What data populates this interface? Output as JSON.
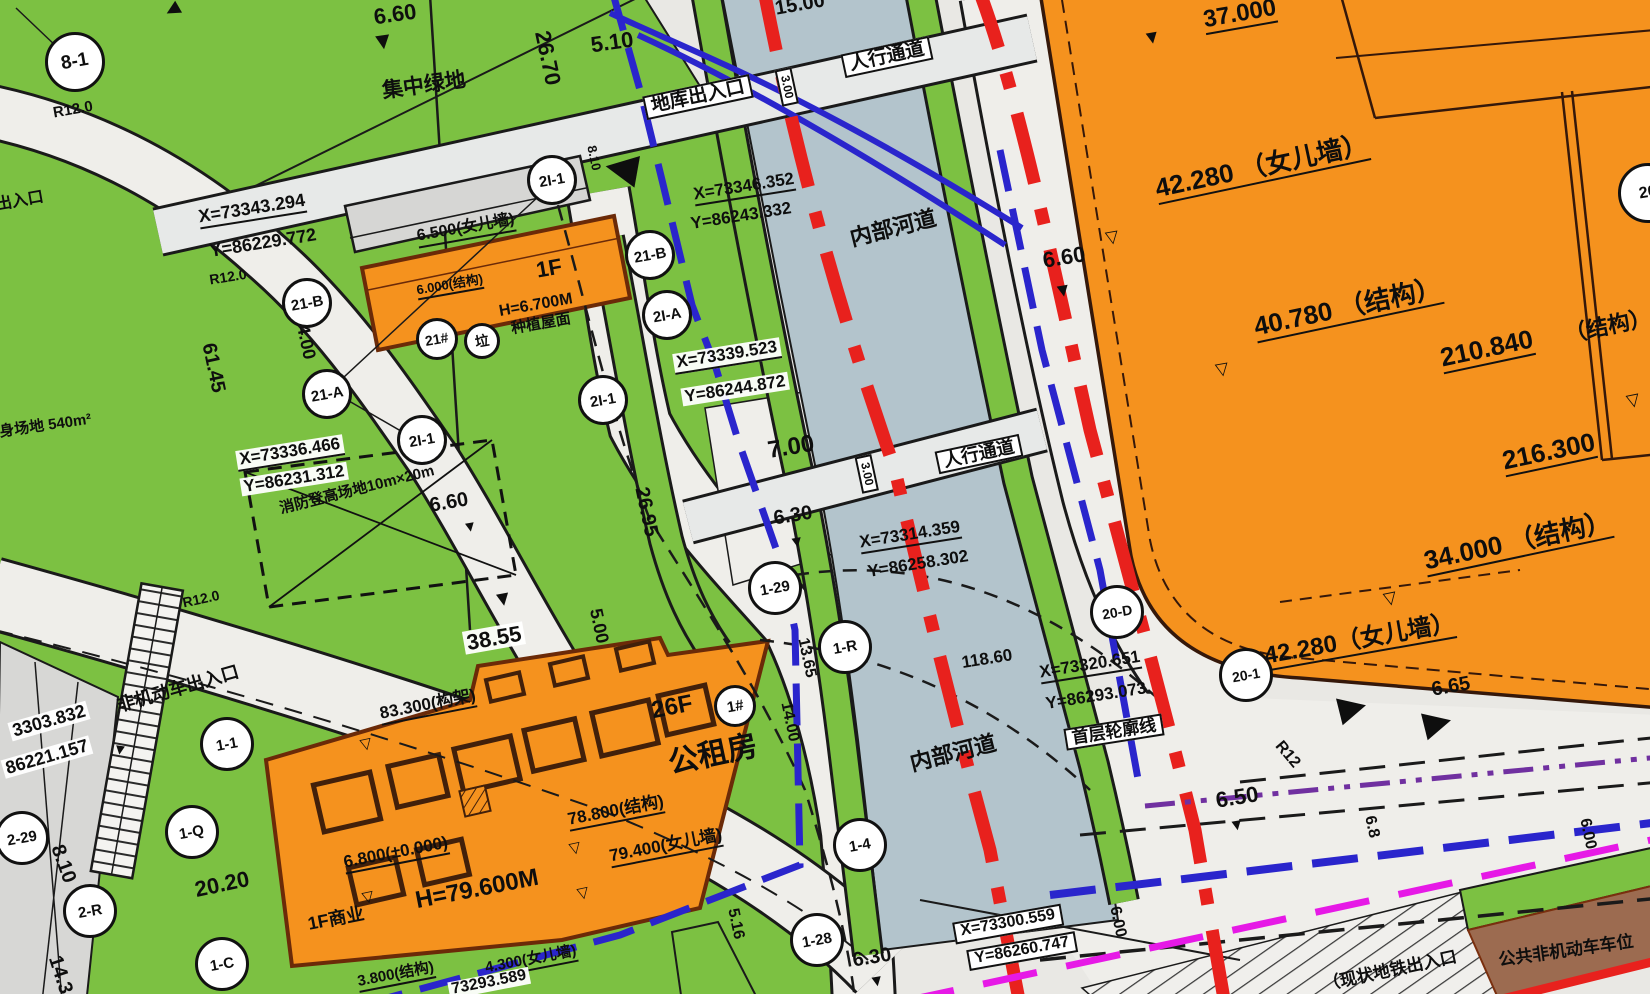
{
  "title": "site-plan-drawing",
  "colors": {
    "green_space": "#7cc142",
    "building_orange": "#f5921e",
    "building_edge": "#6b2a08",
    "river_blue_gray": "#b3c4cc",
    "road_gray": "#e9e8e4",
    "red_line": "#e8211d",
    "blue_line": "#2a25cc",
    "magenta_line": "#e619e6",
    "purple_line": "#7030a0",
    "brown_parking": "#9c6b50",
    "gray_building": "#d6d6d4"
  },
  "labels": [
    {
      "name": "radius-r12-topleft",
      "text": "R12.0",
      "x": 73,
      "y": 110,
      "rot": -10,
      "size": 15,
      "kind": ""
    },
    {
      "name": "exit-partial-left",
      "text": "出入口",
      "x": 20,
      "y": 202,
      "rot": -10,
      "size": 16,
      "kind": ""
    },
    {
      "name": "elev-6-60-top",
      "text": "6.60",
      "x": 395,
      "y": 14,
      "rot": -8,
      "size": 22,
      "kind": ""
    },
    {
      "name": "central-green-space",
      "text": "集中绿地",
      "x": 424,
      "y": 86,
      "rot": -8,
      "size": 21,
      "kind": ""
    },
    {
      "name": "dim-26-70",
      "text": "26.70",
      "x": 548,
      "y": 58,
      "rot": 78,
      "size": 22,
      "kind": ""
    },
    {
      "name": "dim-5-10",
      "text": "5.10",
      "x": 612,
      "y": 42,
      "rot": -8,
      "size": 22,
      "kind": ""
    },
    {
      "name": "garage-entrance",
      "text": "地库出入口",
      "x": 698,
      "y": 97,
      "rot": -12,
      "size": 19,
      "kind": "box"
    },
    {
      "name": "dim-3-00-top",
      "text": "3.00",
      "x": 787,
      "y": 87,
      "rot": 78,
      "size": 12,
      "kind": "box"
    },
    {
      "name": "pedestrian-passage-top",
      "text": "人行通道",
      "x": 887,
      "y": 57,
      "rot": -12,
      "size": 19,
      "kind": "box"
    },
    {
      "name": "dim-15-00",
      "text": "15.00",
      "x": 800,
      "y": 5,
      "rot": -10,
      "size": 20,
      "kind": ""
    },
    {
      "name": "dim-8-10-top",
      "text": "8.10",
      "x": 594,
      "y": 158,
      "rot": 78,
      "size": 13,
      "kind": ""
    },
    {
      "name": "coord-x-73343-294",
      "text": "X=73343.294",
      "x": 252,
      "y": 210,
      "rot": -9,
      "size": 18,
      "kind": "dim"
    },
    {
      "name": "coord-y-86229-772",
      "text": "Y=86229.772",
      "x": 263,
      "y": 243,
      "rot": -9,
      "size": 18,
      "kind": ""
    },
    {
      "name": "radius-r12-road",
      "text": "R12.0",
      "x": 228,
      "y": 277,
      "rot": -9,
      "size": 14,
      "kind": ""
    },
    {
      "name": "dim-4-00",
      "text": "4.00",
      "x": 306,
      "y": 342,
      "rot": 78,
      "size": 18,
      "kind": ""
    },
    {
      "name": "dim-61-45",
      "text": "61.45",
      "x": 213,
      "y": 368,
      "rot": 78,
      "size": 20,
      "kind": ""
    },
    {
      "name": "coord-x-73336-466",
      "text": "X=73336.466",
      "x": 290,
      "y": 453,
      "rot": -9,
      "size": 17,
      "kind": "wbg dim"
    },
    {
      "name": "coord-y-86231-312",
      "text": "Y=86231.312",
      "x": 294,
      "y": 479,
      "rot": -9,
      "size": 17,
      "kind": "wbg"
    },
    {
      "name": "fitness-area-540",
      "text": "健身场地 540m²",
      "x": 38,
      "y": 427,
      "rot": -8,
      "size": 15,
      "kind": ""
    },
    {
      "name": "roof-6-500-parapet",
      "text": "6.500(女儿墙)",
      "x": 466,
      "y": 230,
      "rot": -10,
      "size": 16,
      "kind": "dim"
    },
    {
      "name": "roof-6-000-structure",
      "text": "6.000(结构)",
      "x": 450,
      "y": 286,
      "rot": -10,
      "size": 13,
      "kind": "dim"
    },
    {
      "name": "floors-1f",
      "text": "1F",
      "x": 549,
      "y": 268,
      "rot": -10,
      "size": 22,
      "kind": ""
    },
    {
      "name": "height-6-700",
      "text": "H=6.700M",
      "x": 536,
      "y": 306,
      "rot": -10,
      "size": 16,
      "kind": ""
    },
    {
      "name": "planted-roof",
      "text": "种植屋面",
      "x": 541,
      "y": 324,
      "rot": -10,
      "size": 15,
      "kind": ""
    },
    {
      "name": "coord-x-73346-352",
      "text": "X=73346.352",
      "x": 744,
      "y": 188,
      "rot": -9,
      "size": 17,
      "kind": "dim"
    },
    {
      "name": "coord-y-86243-332",
      "text": "Y=86243.332",
      "x": 741,
      "y": 216,
      "rot": -9,
      "size": 17,
      "kind": ""
    },
    {
      "name": "coord-x-73339-523",
      "text": "X=73339.523",
      "x": 727,
      "y": 356,
      "rot": -9,
      "size": 17,
      "kind": "wbg dim"
    },
    {
      "name": "coord-y-86244-872",
      "text": "Y=86244.872",
      "x": 735,
      "y": 389,
      "rot": -9,
      "size": 17,
      "kind": "wbg"
    },
    {
      "name": "dim-26-95",
      "text": "26.95",
      "x": 646,
      "y": 512,
      "rot": 78,
      "size": 20,
      "kind": ""
    },
    {
      "name": "dim-7-00",
      "text": "7.00",
      "x": 791,
      "y": 447,
      "rot": -9,
      "size": 24,
      "kind": ""
    },
    {
      "name": "elev-6-30-mid",
      "text": "6.30",
      "x": 793,
      "y": 516,
      "rot": -9,
      "size": 20,
      "kind": ""
    },
    {
      "name": "dim-3-00-mid",
      "text": "3.00",
      "x": 867,
      "y": 474,
      "rot": 78,
      "size": 12,
      "kind": "box"
    },
    {
      "name": "pedestrian-passage-mid",
      "text": "人行通道",
      "x": 979,
      "y": 454,
      "rot": -12,
      "size": 18,
      "kind": "box"
    },
    {
      "name": "river-label-top",
      "text": "内部河道",
      "x": 893,
      "y": 228,
      "rot": -14,
      "size": 22,
      "kind": ""
    },
    {
      "name": "elev-6-60-right",
      "text": "6.60",
      "x": 1064,
      "y": 257,
      "rot": -9,
      "size": 22,
      "kind": ""
    },
    {
      "name": "river-label-bottom",
      "text": "内部河道",
      "x": 953,
      "y": 753,
      "rot": -14,
      "size": 22,
      "kind": ""
    },
    {
      "name": "coord-x-73314-359",
      "text": "X=73314.359",
      "x": 910,
      "y": 536,
      "rot": -9,
      "size": 17,
      "kind": "dim"
    },
    {
      "name": "coord-y-86258-302",
      "text": "Y=86258.302",
      "x": 918,
      "y": 564,
      "rot": -9,
      "size": 17,
      "kind": ""
    },
    {
      "name": "dim-118-60",
      "text": "118.60",
      "x": 987,
      "y": 659,
      "rot": -9,
      "size": 17,
      "kind": ""
    },
    {
      "name": "coord-x-73320-651",
      "text": "X=73320.651",
      "x": 1090,
      "y": 666,
      "rot": -9,
      "size": 17,
      "kind": "dim"
    },
    {
      "name": "coord-y-86293-073",
      "text": "Y=86293.073",
      "x": 1096,
      "y": 696,
      "rot": -9,
      "size": 17,
      "kind": ""
    },
    {
      "name": "first-floor-outline",
      "text": "首层轮廓线",
      "x": 1114,
      "y": 732,
      "rot": -9,
      "size": 17,
      "kind": "box"
    },
    {
      "name": "radius-r12-corner",
      "text": "R12",
      "x": 1287,
      "y": 755,
      "rot": 50,
      "size": 16,
      "kind": ""
    },
    {
      "name": "elev-6-50",
      "text": "6.50",
      "x": 1237,
      "y": 797,
      "rot": -9,
      "size": 22,
      "kind": ""
    },
    {
      "name": "dim-13-65",
      "text": "13.65",
      "x": 806,
      "y": 658,
      "rot": 78,
      "size": 16,
      "kind": ""
    },
    {
      "name": "dim-14-00",
      "text": "14.00",
      "x": 789,
      "y": 722,
      "rot": 78,
      "size": 16,
      "kind": ""
    },
    {
      "name": "dim-5-16",
      "text": "5.16",
      "x": 735,
      "y": 924,
      "rot": 78,
      "size": 16,
      "kind": ""
    },
    {
      "name": "elev-6-30-bottom",
      "text": "6.30",
      "x": 872,
      "y": 958,
      "rot": -9,
      "size": 20,
      "kind": ""
    },
    {
      "name": "coord-x-73300-559",
      "text": "X=73300.559",
      "x": 1008,
      "y": 924,
      "rot": -10,
      "size": 16,
      "kind": "box dim"
    },
    {
      "name": "coord-y-86260-747",
      "text": "Y=86260.747",
      "x": 1022,
      "y": 951,
      "rot": -10,
      "size": 16,
      "kind": "box"
    },
    {
      "name": "dim-6-00-left",
      "text": "6.00",
      "x": 1117,
      "y": 922,
      "rot": 78,
      "size": 16,
      "kind": ""
    },
    {
      "name": "dim-6-8",
      "text": "6.8",
      "x": 1371,
      "y": 827,
      "rot": 78,
      "size": 16,
      "kind": ""
    },
    {
      "name": "dim-6-00-right",
      "text": "6.00",
      "x": 1587,
      "y": 834,
      "rot": 78,
      "size": 16,
      "kind": ""
    },
    {
      "name": "existing-metro-exit",
      "text": "（现状地铁出入口",
      "x": 1390,
      "y": 971,
      "rot": -12,
      "size": 17,
      "kind": ""
    },
    {
      "name": "public-bicycle-parking",
      "text": "公共非机动车车位",
      "x": 1566,
      "y": 951,
      "rot": -8,
      "size": 17,
      "kind": ""
    },
    {
      "name": "roof-42-280-parapet-low",
      "text": "42.280（女儿墙）",
      "x": 1360,
      "y": 641,
      "rot": -10,
      "size": 24,
      "kind": "dim"
    },
    {
      "name": "elev-6-65",
      "text": "6.65",
      "x": 1451,
      "y": 687,
      "rot": -10,
      "size": 20,
      "kind": ""
    },
    {
      "name": "roof-37-000",
      "text": "37.000",
      "x": 1240,
      "y": 15,
      "rot": -10,
      "size": 24,
      "kind": "dim"
    },
    {
      "name": "roof-42-280-parapet",
      "text": "42.280 （女儿墙）",
      "x": 1262,
      "y": 168,
      "rot": -12,
      "size": 26,
      "kind": "dim"
    },
    {
      "name": "roof-40-780-structure",
      "text": "40.780 （结构）",
      "x": 1348,
      "y": 309,
      "rot": -12,
      "size": 26,
      "kind": "dim"
    },
    {
      "name": "roof-210-840",
      "text": "210.840",
      "x": 1487,
      "y": 350,
      "rot": -12,
      "size": 26,
      "kind": "dim"
    },
    {
      "name": "roof-210-840-structure",
      "text": "（结构）",
      "x": 1608,
      "y": 326,
      "rot": -12,
      "size": 22,
      "kind": ""
    },
    {
      "name": "roof-216-300",
      "text": "216.300",
      "x": 1549,
      "y": 453,
      "rot": -12,
      "size": 26,
      "kind": "dim"
    },
    {
      "name": "roof-34-000-structure",
      "text": "34.000 （结构）",
      "x": 1518,
      "y": 543,
      "rot": -12,
      "size": 26,
      "kind": "dim"
    },
    {
      "name": "fire-truck-area",
      "text": "消防登高场地10m×20m",
      "x": 357,
      "y": 490,
      "rot": -14,
      "size": 15,
      "kind": ""
    },
    {
      "name": "elev-6-60-fire",
      "text": "6.60",
      "x": 449,
      "y": 503,
      "rot": -10,
      "size": 20,
      "kind": ""
    },
    {
      "name": "dim-38-55",
      "text": "38.55",
      "x": 494,
      "y": 638,
      "rot": -10,
      "size": 22,
      "kind": "wbg"
    },
    {
      "name": "dim-5-00",
      "text": "5.00",
      "x": 599,
      "y": 626,
      "rot": 78,
      "size": 18,
      "kind": ""
    },
    {
      "name": "roof-83-300-frame",
      "text": "83.300(构架)",
      "x": 428,
      "y": 706,
      "rot": -11,
      "size": 17,
      "kind": "dim"
    },
    {
      "name": "floors-26f",
      "text": "26F",
      "x": 672,
      "y": 707,
      "rot": -11,
      "size": 24,
      "kind": ""
    },
    {
      "name": "public-rental-housing",
      "text": "公租房",
      "x": 713,
      "y": 755,
      "rot": -12,
      "size": 30,
      "kind": ""
    },
    {
      "name": "roof-78-800-structure",
      "text": "78.800(结构)",
      "x": 616,
      "y": 812,
      "rot": -11,
      "size": 17,
      "kind": "dim"
    },
    {
      "name": "roof-79-400-parapet",
      "text": "79.400(女儿墙)",
      "x": 666,
      "y": 847,
      "rot": -11,
      "size": 17,
      "kind": "dim"
    },
    {
      "name": "elev-6-800-zero",
      "text": "6.800(±0.000)",
      "x": 396,
      "y": 854,
      "rot": -11,
      "size": 17,
      "kind": "dim"
    },
    {
      "name": "height-79-600",
      "text": "H=79.600M",
      "x": 477,
      "y": 889,
      "rot": -11,
      "size": 24,
      "kind": ""
    },
    {
      "name": "commercial-1f",
      "text": "1F商业",
      "x": 336,
      "y": 919,
      "rot": -11,
      "size": 18,
      "kind": ""
    },
    {
      "name": "roof-3-800-structure",
      "text": "3.800(结构)",
      "x": 396,
      "y": 976,
      "rot": -11,
      "size": 15,
      "kind": "dim"
    },
    {
      "name": "roof-4-300-parapet",
      "text": "4.300(女儿墙)",
      "x": 531,
      "y": 961,
      "rot": -11,
      "size": 15,
      "kind": "dim"
    },
    {
      "name": "coord-73293-589",
      "text": "73293.589",
      "x": 489,
      "y": 983,
      "rot": -11,
      "size": 16,
      "kind": "wbg"
    },
    {
      "name": "non-motor-entrance",
      "text": "非机动车出入口",
      "x": 178,
      "y": 689,
      "rot": -16,
      "size": 18,
      "kind": ""
    },
    {
      "name": "coord-3303-832",
      "text": "3303.832",
      "x": 49,
      "y": 721,
      "rot": -16,
      "size": 18,
      "kind": "wbg"
    },
    {
      "name": "coord-86221-157",
      "text": "86221.157",
      "x": 47,
      "y": 757,
      "rot": -16,
      "size": 18,
      "kind": "wbg"
    },
    {
      "name": "radius-r12-bottomroad",
      "text": "R12.0",
      "x": 201,
      "y": 599,
      "rot": -12,
      "size": 14,
      "kind": ""
    },
    {
      "name": "dim-20-20",
      "text": "20.20",
      "x": 222,
      "y": 884,
      "rot": -12,
      "size": 22,
      "kind": ""
    },
    {
      "name": "dim-8-10-bottom",
      "text": "8.10",
      "x": 63,
      "y": 864,
      "rot": 70,
      "size": 20,
      "kind": ""
    },
    {
      "name": "dim-14-3",
      "text": "14.3",
      "x": 60,
      "y": 975,
      "rot": 72,
      "size": 20,
      "kind": ""
    }
  ],
  "circles": [
    {
      "name": "plot-8-1",
      "text": "8-1",
      "x": 75,
      "y": 62,
      "r": 30,
      "size": 19
    },
    {
      "name": "plot-2i-1-a",
      "text": "2I-1",
      "x": 552,
      "y": 180,
      "r": 25,
      "size": 15
    },
    {
      "name": "plot-21-b-a",
      "text": "21-B",
      "x": 307,
      "y": 303,
      "r": 25,
      "size": 15
    },
    {
      "name": "plot-21-a-a",
      "text": "21-A",
      "x": 327,
      "y": 394,
      "r": 25,
      "size": 15
    },
    {
      "name": "plot-2i-1-b",
      "text": "2I-1",
      "x": 422,
      "y": 440,
      "r": 25,
      "size": 15
    },
    {
      "name": "plot-21-b-b",
      "text": "21-B",
      "x": 650,
      "y": 255,
      "r": 25,
      "size": 15
    },
    {
      "name": "plot-2i-a",
      "text": "2I-A",
      "x": 667,
      "y": 315,
      "r": 25,
      "size": 15
    },
    {
      "name": "plot-2i-1-c",
      "text": "2I-1",
      "x": 603,
      "y": 400,
      "r": 25,
      "size": 15
    },
    {
      "name": "building-21",
      "text": "21#",
      "x": 437,
      "y": 339,
      "r": 21,
      "size": 14
    },
    {
      "name": "trash-symbol",
      "text": "垃",
      "x": 482,
      "y": 341,
      "r": 18,
      "size": 14
    },
    {
      "name": "building-1",
      "text": "1#",
      "x": 735,
      "y": 706,
      "r": 21,
      "size": 15
    },
    {
      "name": "plot-1-29",
      "text": "1-29",
      "x": 775,
      "y": 588,
      "r": 27,
      "size": 15
    },
    {
      "name": "plot-1-r",
      "text": "1-R",
      "x": 845,
      "y": 647,
      "r": 27,
      "size": 15
    },
    {
      "name": "plot-1-4",
      "text": "1-4",
      "x": 860,
      "y": 845,
      "r": 27,
      "size": 15
    },
    {
      "name": "plot-1-28",
      "text": "1-28",
      "x": 817,
      "y": 940,
      "r": 27,
      "size": 15
    },
    {
      "name": "plot-1-1",
      "text": "1-1",
      "x": 227,
      "y": 744,
      "r": 27,
      "size": 15
    },
    {
      "name": "plot-1-q",
      "text": "1-Q",
      "x": 192,
      "y": 832,
      "r": 27,
      "size": 15
    },
    {
      "name": "plot-2-r",
      "text": "2-R",
      "x": 90,
      "y": 911,
      "r": 27,
      "size": 15
    },
    {
      "name": "plot-2-29",
      "text": "2-29",
      "x": 22,
      "y": 838,
      "r": 27,
      "size": 15
    },
    {
      "name": "plot-1-c",
      "text": "1-C",
      "x": 222,
      "y": 964,
      "r": 27,
      "size": 15
    },
    {
      "name": "plot-20-d",
      "text": "20-D",
      "x": 1117,
      "y": 612,
      "r": 27,
      "size": 14
    },
    {
      "name": "plot-20-1",
      "text": "20-1",
      "x": 1246,
      "y": 675,
      "r": 27,
      "size": 14
    },
    {
      "name": "plot-20-partial",
      "text": "20",
      "x": 1648,
      "y": 193,
      "r": 30,
      "size": 16
    }
  ],
  "markers": [
    {
      "name": "spot-arrow-top-green",
      "glyph": "▼",
      "x": 383,
      "y": 42,
      "rot": -8,
      "size": 24
    },
    {
      "name": "spot-arrow-fire",
      "glyph": "▼",
      "x": 470,
      "y": 527,
      "rot": -10,
      "size": 15
    },
    {
      "name": "down-arrow-38-55",
      "glyph": "▼",
      "x": 503,
      "y": 599,
      "rot": -10,
      "size": 21
    },
    {
      "name": "left-arrow-garage",
      "glyph": "◀",
      "x": 622,
      "y": 166,
      "rot": 10,
      "size": 42
    },
    {
      "name": "spot-arrow-6-60-right",
      "glyph": "▼",
      "x": 1063,
      "y": 291,
      "rot": -10,
      "size": 19
    },
    {
      "name": "spot-arrow-6-50",
      "glyph": "▼",
      "x": 1237,
      "y": 826,
      "rot": -10,
      "size": 16
    },
    {
      "name": "spot-arrow-6-30-bottom",
      "glyph": "▼",
      "x": 877,
      "y": 982,
      "rot": -10,
      "size": 16
    },
    {
      "name": "spot-arrow-37-000",
      "glyph": "▼",
      "x": 1152,
      "y": 38,
      "rot": -10,
      "size": 19
    },
    {
      "name": "spot-arrow-6-30-mid",
      "glyph": "▼",
      "x": 797,
      "y": 543,
      "rot": -10,
      "size": 16
    },
    {
      "name": "big-arrow-right-1",
      "glyph": "▶",
      "x": 1352,
      "y": 706,
      "rot": -14,
      "size": 36
    },
    {
      "name": "big-arrow-right-2",
      "glyph": "▶",
      "x": 1437,
      "y": 721,
      "rot": -14,
      "size": 36
    },
    {
      "name": "open-tri-42-280",
      "glyph": "▽",
      "x": 1112,
      "y": 237,
      "rot": -10,
      "size": 17
    },
    {
      "name": "open-tri-40-780",
      "glyph": "▽",
      "x": 1222,
      "y": 369,
      "rot": -10,
      "size": 17
    },
    {
      "name": "open-tri-34-000",
      "glyph": "▽",
      "x": 1390,
      "y": 598,
      "rot": -12,
      "size": 17
    },
    {
      "name": "open-tri-216-300",
      "glyph": "▽",
      "x": 1633,
      "y": 400,
      "rot": -12,
      "size": 17
    },
    {
      "name": "open-tri-78-800",
      "glyph": "▽",
      "x": 575,
      "y": 848,
      "rot": -12,
      "size": 15
    },
    {
      "name": "open-tri-79-400",
      "glyph": "▽",
      "x": 583,
      "y": 893,
      "rot": -12,
      "size": 15
    },
    {
      "name": "open-tri-6-800",
      "glyph": "▽",
      "x": 368,
      "y": 897,
      "rot": -12,
      "size": 15
    },
    {
      "name": "open-tri-83-300",
      "glyph": "▽",
      "x": 366,
      "y": 744,
      "rot": -12,
      "size": 15
    },
    {
      "name": "small-arrow-topleft",
      "glyph": "◀",
      "x": 172,
      "y": 9,
      "rot": -30,
      "size": 18
    },
    {
      "name": "stairs-arrow",
      "glyph": "▼",
      "x": 120,
      "y": 750,
      "rot": 8,
      "size": 15
    }
  ]
}
